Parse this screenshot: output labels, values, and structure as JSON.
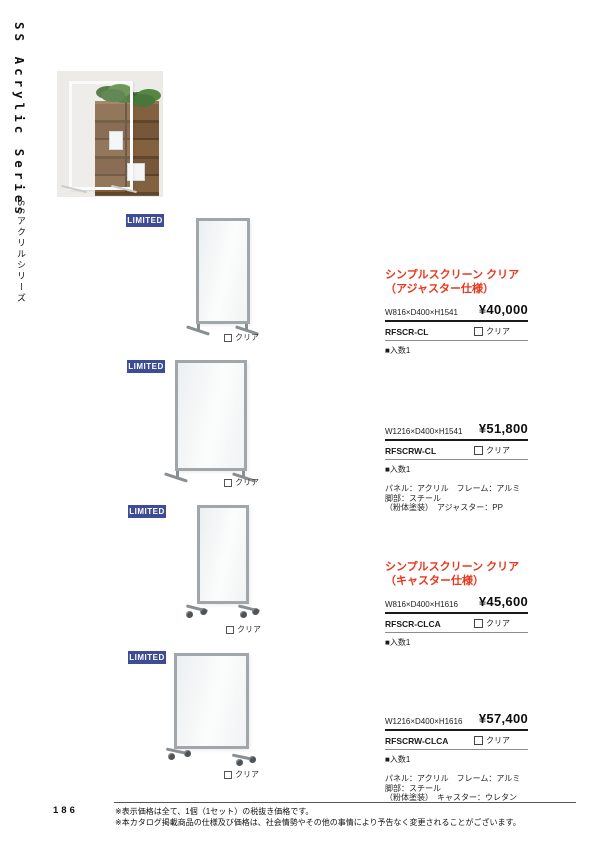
{
  "sidebar": {
    "series_en": "SS Acrylic Series",
    "series_ja": "SSアクリルシリーズ"
  },
  "badge_label": "LIMITED",
  "colors": {
    "accent_red": "#e8371d",
    "badge_navy": "#3e4b95",
    "frame_gray": "#a0a6a9"
  },
  "products": [
    {
      "title_line1": "シンプルスクリーン クリア",
      "title_line2": "（アジャスター仕様）",
      "size": "W816×D400×H1541",
      "price": "¥40,000",
      "code": "RFSCR-CL",
      "color_option": "クリア",
      "quantity": "■入数1"
    },
    {
      "size": "W1216×D400×H1541",
      "price": "¥51,800",
      "code": "RFSCRW-CL",
      "color_option": "クリア",
      "quantity": "■入数1",
      "spec_line1": "パネル：アクリル　フレーム：アルミ　脚部：スチール",
      "spec_line2": "（粉体塗装）　アジャスター：PP"
    },
    {
      "title_line1": "シンプルスクリーン クリア",
      "title_line2": "（キャスター仕様）",
      "size": "W816×D400×H1616",
      "price": "¥45,600",
      "code": "RFSCR-CLCA",
      "color_option": "クリア",
      "quantity": "■入数1"
    },
    {
      "size": "W1216×D400×H1616",
      "price": "¥57,400",
      "code": "RFSCRW-CLCA",
      "color_option": "クリア",
      "quantity": "■入数1",
      "spec_line1": "パネル：アクリル　フレーム：アルミ　脚部：スチール",
      "spec_line2": "（粉体塗装）　キャスター：ウレタン"
    }
  ],
  "footer": {
    "page_number": "186",
    "note1": "※表示価格は全て、1個（1セット）の税抜き価格です。",
    "note2": "※本カタログ掲載商品の仕様及び価格は、社会情勢やその他の事情により予告なく変更されることがございます。"
  }
}
